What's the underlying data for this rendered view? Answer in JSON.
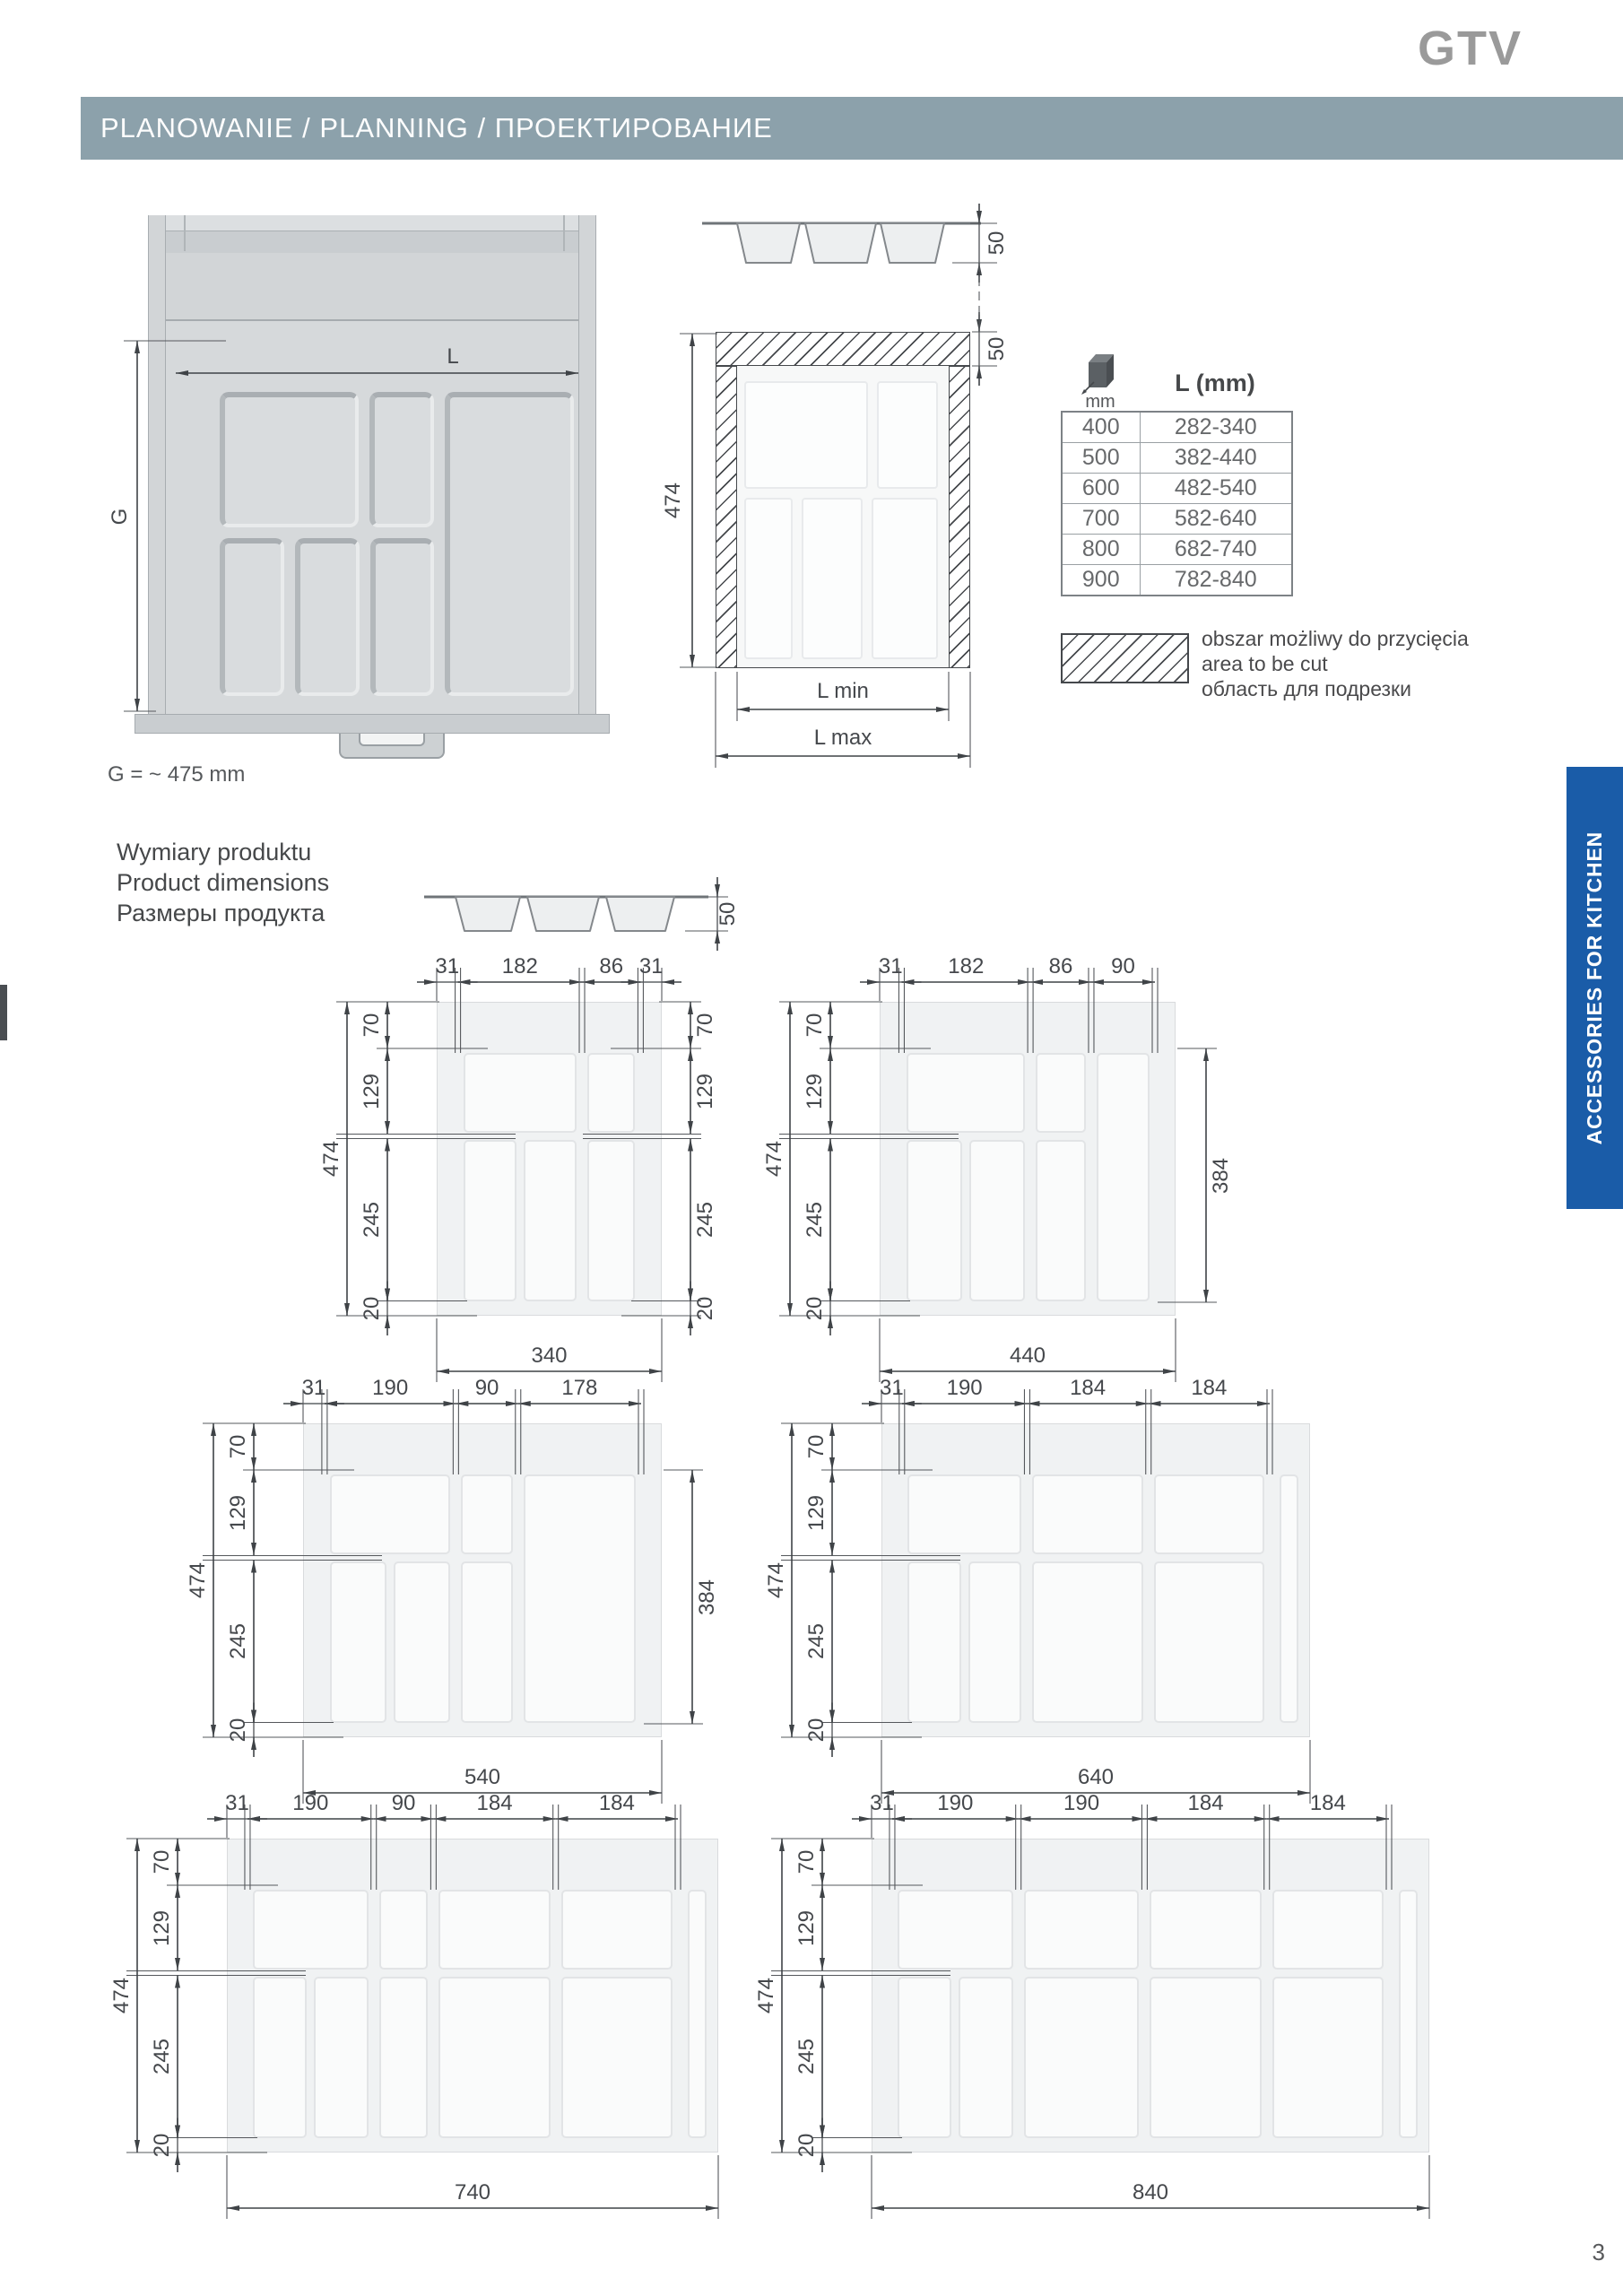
{
  "brand": {
    "logo_text": "GTV"
  },
  "colors": {
    "header_bar": "#8ca1ab",
    "tab_blue": "#1a5ca8",
    "logo_gray": "#9a9a9a",
    "hatch": "#45484c",
    "dim_text": "#45484c"
  },
  "header": {
    "title": "PLANOWANIE / PLANNING / ПРОЕКТИРОВАНИЕ"
  },
  "planning": {
    "drawer": {
      "dim_l": "L",
      "dim_g": "G",
      "note": "G = ~ 475 mm"
    },
    "section": {
      "dim_474": "474",
      "dim_50_top": "50",
      "dim_50_band": "50",
      "l_min": "L min",
      "l_max": "L max"
    },
    "table": {
      "col1_header": "mm",
      "col2_header": "L (mm)",
      "rows": [
        {
          "mm": "400",
          "l": "282-340"
        },
        {
          "mm": "500",
          "l": "382-440"
        },
        {
          "mm": "600",
          "l": "482-540"
        },
        {
          "mm": "700",
          "l": "582-640"
        },
        {
          "mm": "800",
          "l": "682-740"
        },
        {
          "mm": "900",
          "l": "782-840"
        }
      ]
    },
    "legend": {
      "lines": [
        "obszar możliwy do przycięcia",
        "area to be cut",
        "область для подрезки"
      ]
    }
  },
  "product_dimensions": {
    "title_lines": [
      "Wymiary produktu",
      "Product dimensions",
      "Размеры продукта"
    ],
    "profile_dim": "50",
    "diagrams": [
      {
        "name": "tray-340",
        "top_dims": [
          "31",
          "182",
          "86",
          "31"
        ],
        "left_dims": [
          "70",
          "129",
          "245",
          "20"
        ],
        "left_overall": "474",
        "right_dims": [
          "70",
          "129",
          "245",
          "20"
        ],
        "right_overall": null,
        "bottom": "340"
      },
      {
        "name": "tray-440",
        "top_dims": [
          "31",
          "182",
          "86",
          "90"
        ],
        "left_dims": [
          "70",
          "129",
          "245",
          "20"
        ],
        "left_overall": "474",
        "right_dims": null,
        "right_overall": "384",
        "bottom": "440"
      },
      {
        "name": "tray-540",
        "top_dims": [
          "31",
          "190",
          "90",
          "178"
        ],
        "left_dims": [
          "70",
          "129",
          "245",
          "20"
        ],
        "left_overall": "474",
        "right_dims": null,
        "right_overall": "384",
        "bottom": "540"
      },
      {
        "name": "tray-640",
        "top_dims": [
          "31",
          "190",
          "184",
          "184"
        ],
        "left_dims": [
          "70",
          "129",
          "245",
          "20"
        ],
        "left_overall": "474",
        "right_dims": null,
        "right_overall": null,
        "bottom": "640"
      },
      {
        "name": "tray-740",
        "top_dims": [
          "31",
          "190",
          "90",
          "184",
          "184"
        ],
        "left_dims": [
          "70",
          "129",
          "245",
          "20"
        ],
        "left_overall": "474",
        "right_dims": null,
        "right_overall": null,
        "bottom": "740"
      },
      {
        "name": "tray-840",
        "top_dims": [
          "31",
          "190",
          "190",
          "184",
          "184"
        ],
        "left_dims": [
          "70",
          "129",
          "245",
          "20"
        ],
        "left_overall": "474",
        "right_dims": null,
        "right_overall": null,
        "bottom": "840"
      }
    ]
  },
  "sidebar_tab": {
    "label": "ACCESSORIES FOR KITCHEN"
  },
  "page": {
    "number": "3"
  }
}
